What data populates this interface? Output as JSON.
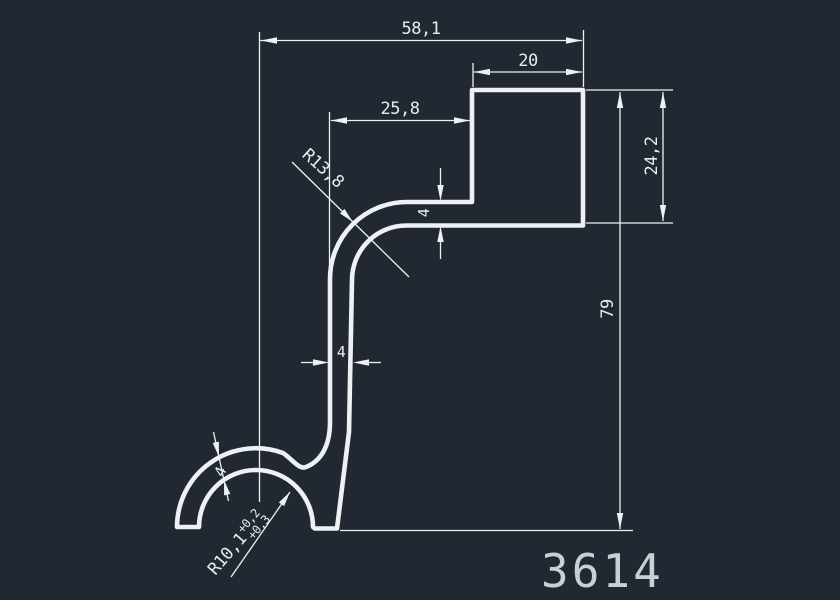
{
  "drawing": {
    "part_number": "3614",
    "dimensions": {
      "overall_width": "58,1",
      "top_block_width": "20",
      "arm_offset": "25,8",
      "top_block_height": "24,2",
      "total_height": "79",
      "arm_thickness": "4",
      "stem_thickness": "4",
      "hook_wall_thickness": "4",
      "fillet_radius": "R13,8",
      "hook_radius": "R10,1",
      "hook_radius_tol_upper": "+0,2",
      "hook_radius_tol_lower": "+0,3"
    },
    "colors": {
      "background": "#212832",
      "line": "#eef1f4",
      "text": "#e8ecef",
      "part_number_text": "#c9cfd5"
    }
  }
}
